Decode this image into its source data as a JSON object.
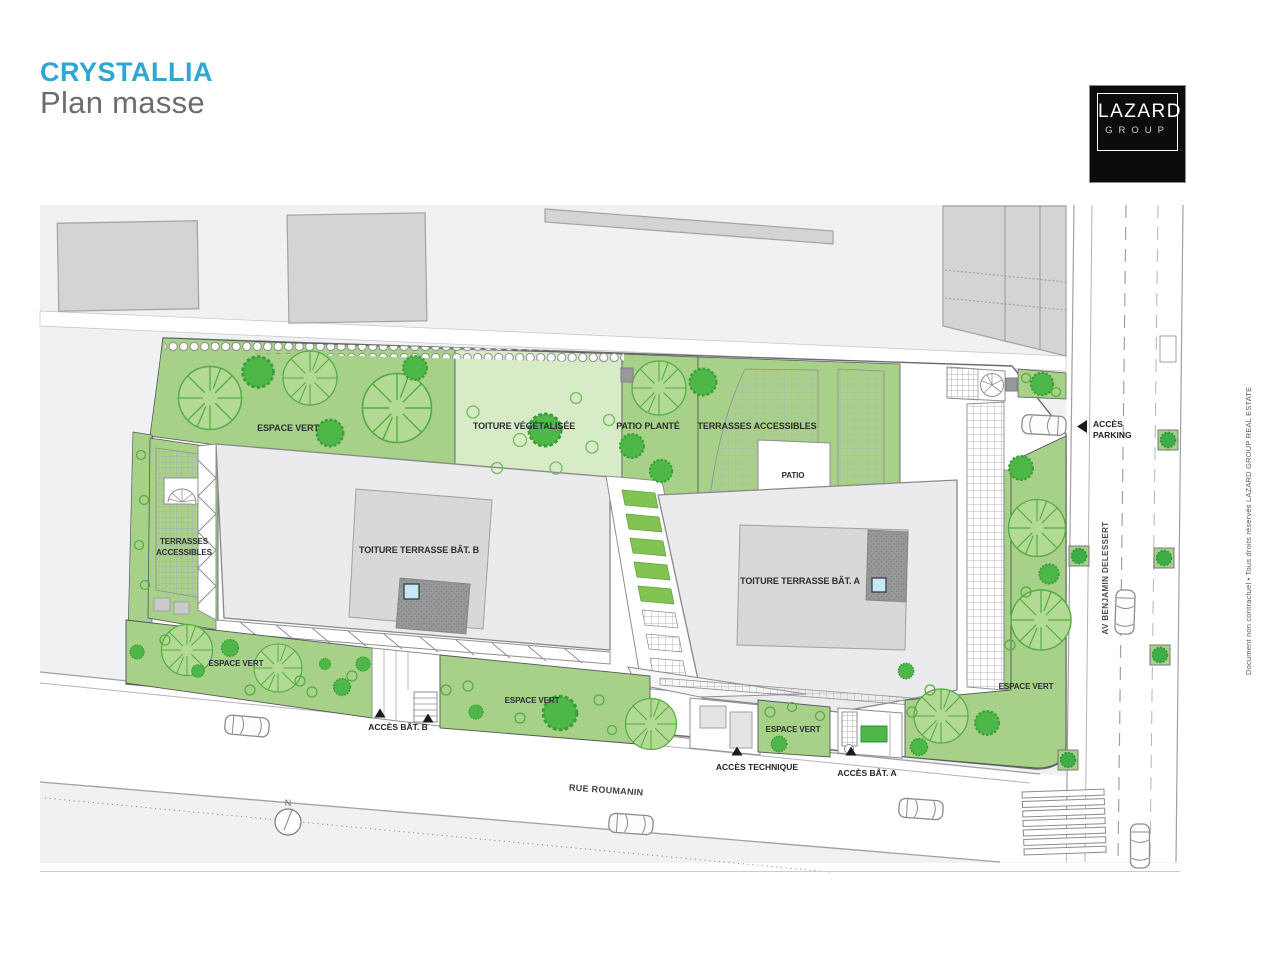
{
  "header": {
    "project_title": "CRYSTALLIA",
    "page_title": "Plan masse",
    "accent_color": "#2fa7d4"
  },
  "logo": {
    "line1": "LAZARD",
    "line2": "GROUP"
  },
  "plan": {
    "zones": {
      "espace_vert_top": "ESPACE VERT",
      "toiture_vegetalisee": "TOITURE VÉGÉTALISÉE",
      "patio_plante": "PATIO PLANTÉ",
      "terrasses_accessibles": "TERRASSES ACCESSIBLES",
      "patio": "PATIO",
      "terrasses_left_line1": "TERRASSES",
      "terrasses_left_line2": "ACCESSIBLES",
      "toiture_terrasse_bat_b": "TOITURE TERRASSE BÂT. B",
      "toiture_terrasse_bat_a": "TOITURE TERRASSE BÂT. A",
      "espace_vert_bottom_left": "ESPACE VERT",
      "espace_vert_bottom_center": "ESPACE VERT",
      "espace_vert_bottom_mid": "ESPACE VERT",
      "espace_vert_right": "ESPACE VERT"
    },
    "access": {
      "bat_b": "ACCÈS BÂT. B",
      "technique": "ACCÈS TECHNIQUE",
      "bat_a": "ACCÈS BÂT. A",
      "parking_line1": "ACCÈS",
      "parking_line2": "PARKING"
    },
    "streets": {
      "rue": "RUE ROUMANIN",
      "avenue": "AV BENJAMIN DELESSERT"
    },
    "north_label": "N",
    "colors": {
      "green": "#a7d188",
      "light_green": "#d8ebc7",
      "tree": "#4db848",
      "building_slab": "#ebebed",
      "roof": "#d7d8da",
      "dark_roof": "#97989a",
      "skylight": "#c7e8f6",
      "neighbor_building": "#d3d4d6",
      "background": "#f0f1f2"
    }
  },
  "footer": {
    "disclaimer": "Document non contractuel • Tous droits réservés LAZARD GROUP REAL ESTATE"
  }
}
